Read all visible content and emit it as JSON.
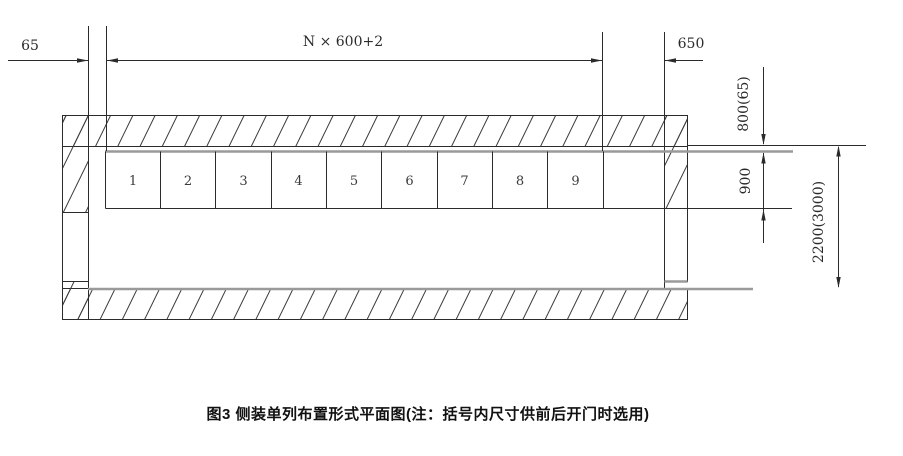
{
  "caption": "图3  侧装单列布置形式平面图(注：括号内尺寸供前后开门时选用)",
  "cells": [
    "1",
    "2",
    "3",
    "4",
    "5",
    "6",
    "7",
    "8",
    "9"
  ],
  "dims": {
    "left_gap": "65",
    "bay_width": "N × 600+2",
    "right_end": "650",
    "top_clearance": "800(65)",
    "unit_depth": "900",
    "room_depth": "2200(3000)"
  },
  "colors": {
    "line": "#2b2b2b",
    "thick_gray": "#9a9a9a"
  }
}
